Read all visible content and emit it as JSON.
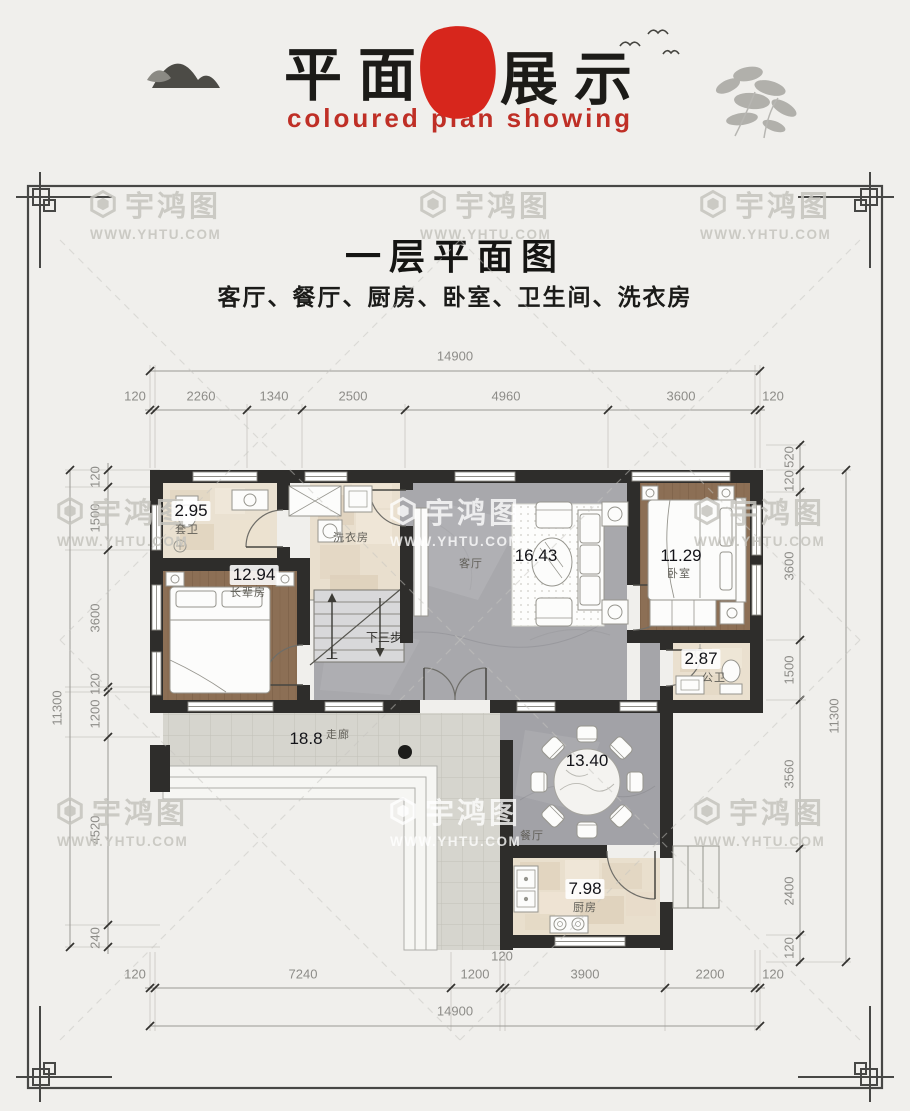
{
  "header": {
    "brand_cn_left": "平面",
    "brand_cn_right": "展示",
    "seal_line1": "宇",
    "seal_line2": "鸿",
    "subtitle_en": "coloured plan showing"
  },
  "watermark": {
    "brand": "宇鸿图",
    "url": "WWW.YHTU.COM"
  },
  "title": {
    "main": "一层平面图",
    "rooms_line": "客厅、餐厅、厨房、卧室、卫生间、洗衣房"
  },
  "rooms": {
    "ensuite": {
      "name": "套卫",
      "area": "2.95"
    },
    "elder": {
      "name": "长辈房",
      "area": "12.94"
    },
    "laundry": {
      "name": "洗衣房"
    },
    "living": {
      "name": "客厅",
      "area": "16.43"
    },
    "bedroom": {
      "name": "卧室",
      "area": "11.29"
    },
    "bath": {
      "name": "公卫",
      "area": "2.87"
    },
    "corridor": {
      "name": "走廊",
      "area": "18.8"
    },
    "dining": {
      "name": "餐厅",
      "area": "13.40"
    },
    "kitchen": {
      "name": "厨房",
      "area": "7.98"
    }
  },
  "stairs": {
    "up": "上",
    "down": "下三步"
  },
  "dims": {
    "top": {
      "overall": "14900",
      "segments": [
        "120",
        "2260",
        "1340",
        "2500",
        "4960",
        "3600",
        "120"
      ]
    },
    "bottom": {
      "overall": "14900",
      "segments": [
        "120",
        "7240",
        "1200",
        "120",
        "3900",
        "2200",
        "120"
      ]
    },
    "left": {
      "overall": "11300",
      "segments": [
        "120",
        "1500",
        "3600",
        "120",
        "1200",
        "4520",
        "240"
      ]
    },
    "right": {
      "overall": "11300",
      "segments": [
        "520",
        "120",
        "3600",
        "1500",
        "3560",
        "2400",
        "120"
      ]
    }
  },
  "colors": {
    "seal_red": "#d7261c",
    "accent_red": "#bf2f26",
    "wall": "#2e2d2b"
  }
}
